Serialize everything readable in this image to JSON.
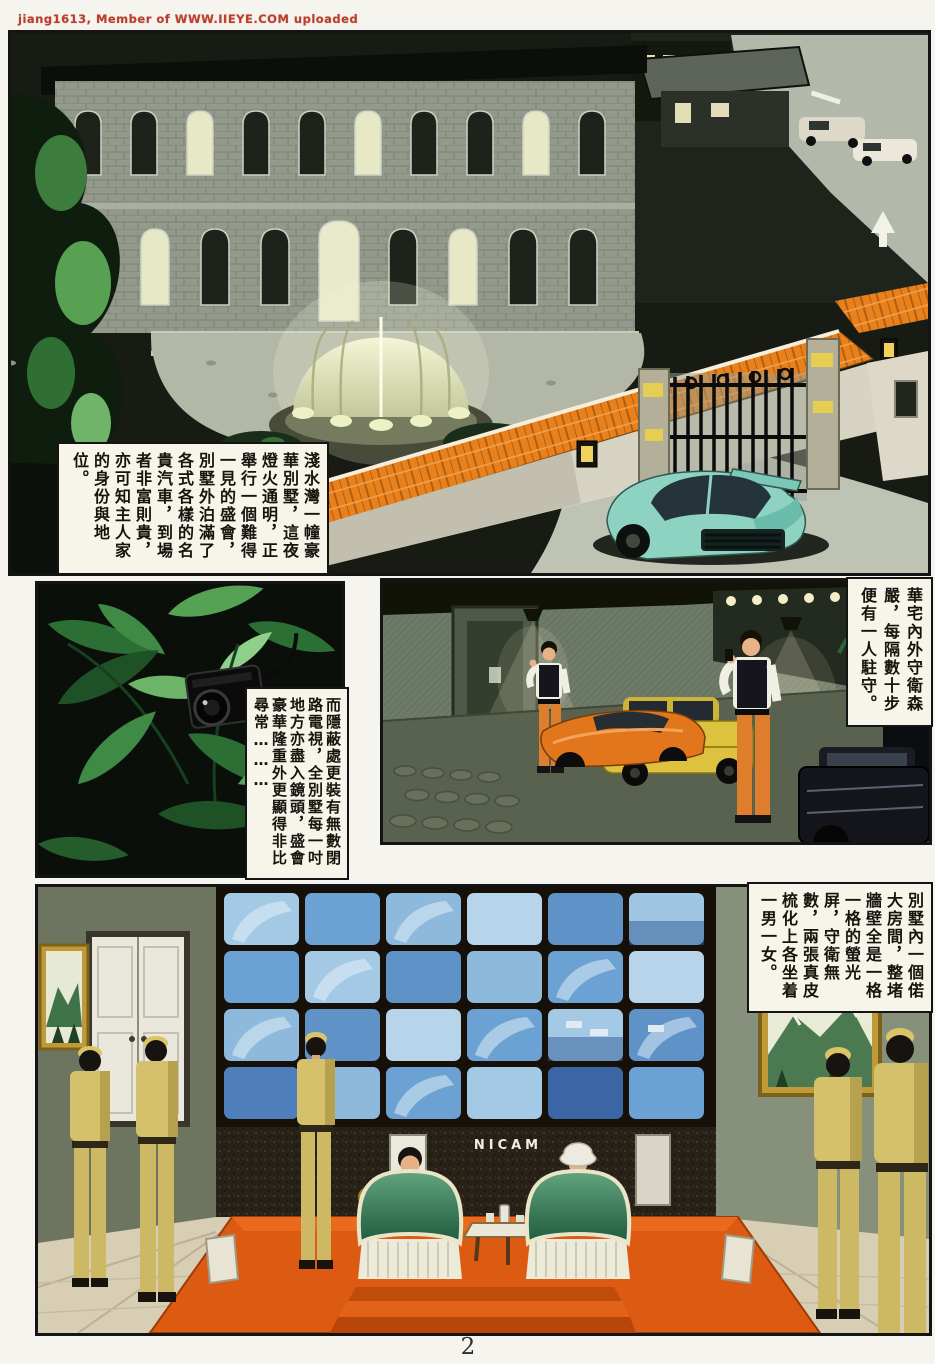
{
  "page": {
    "watermark": "jiang1613, Member of WWW.IIEYE.COM uploaded",
    "page_number": "2"
  },
  "captions": {
    "mansion": "淺水灣一幢豪華別墅，這夜燈火通明，正舉行一個難得一見的盛會，別墅外泊滿了各式各樣的名貴汽車，到場者非富則貴，亦可知主人家的身份與地位。",
    "guards": "華宅內外守衛森嚴，每隔數十步便有一人駐守。",
    "camera": "而隱蔽處更裝有無數閉路電視，全別墅每一吋地方亦盡入鏡頭，盛會豪華隆重外更顯得非比尋常………",
    "control_room": "別墅內一個偌大房間，整堵牆壁全是一格一格的螢光屏，守衛無數，兩張真皮梳化上各坐着一男一女。"
  },
  "labels": {
    "monitor_brand": "NICAM"
  },
  "colors": {
    "roof_orange": "#e8811c",
    "car_teal": "#8ed2c2",
    "monitor_blue": "#6ca2d3",
    "carpet_orange": "#dd5a10",
    "foliage_green": "#2e7336",
    "uniform_khaki": "#d5c06c",
    "guard_pants_orange": "#de7e2d",
    "watermark_red": "#c23c28"
  }
}
